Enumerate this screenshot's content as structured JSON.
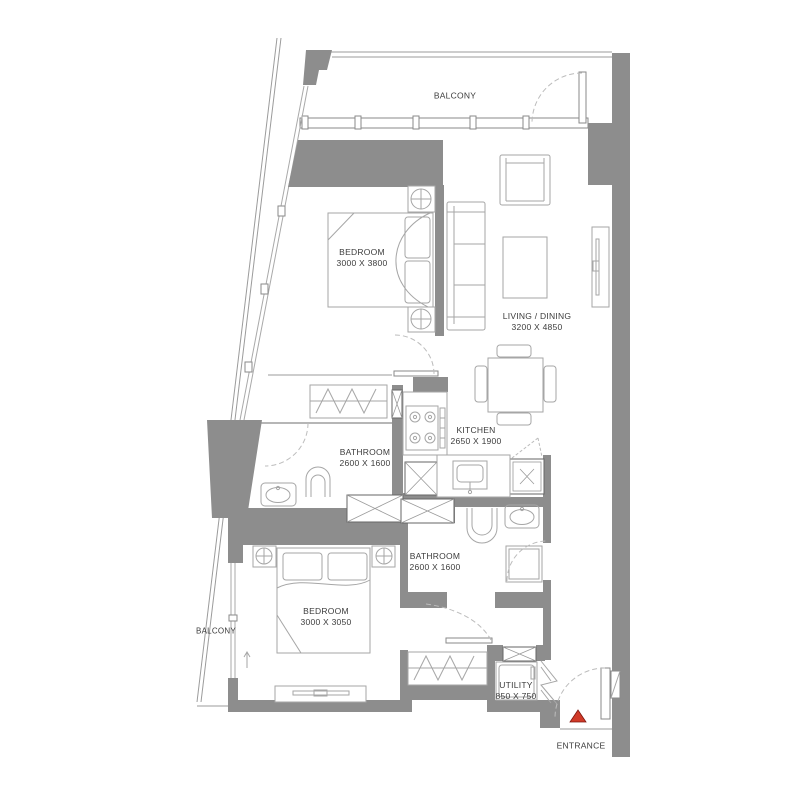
{
  "title": "Apartment Floor Plan",
  "colors": {
    "wall": "#8d8d8d",
    "outline": "#6d6d6d",
    "furniture_line": "#a6a6a6",
    "door_arc": "#bcbcbc",
    "label_text": "#3c3c3c",
    "entrance_marker": "#d03a28"
  },
  "rooms": [
    {
      "id": "balcony-top",
      "name": "BALCONY",
      "dims": ""
    },
    {
      "id": "bedroom-1",
      "name": "BEDROOM",
      "dims": "3000 X 3800"
    },
    {
      "id": "living-dining",
      "name": "LIVING / DINING",
      "dims": "3200 X 4850"
    },
    {
      "id": "kitchen",
      "name": "KITCHEN",
      "dims": "2650 X 1900"
    },
    {
      "id": "bathroom-1",
      "name": "BATHROOM",
      "dims": "2600 X 1600"
    },
    {
      "id": "bathroom-2",
      "name": "BATHROOM",
      "dims": "2600 X 1600"
    },
    {
      "id": "bedroom-2",
      "name": "BEDROOM",
      "dims": "3000 X 3050"
    },
    {
      "id": "balcony-left",
      "name": "BALCONY",
      "dims": ""
    },
    {
      "id": "utility",
      "name": "UTILITY",
      "dims": "850 X 750"
    },
    {
      "id": "entrance",
      "name": "ENTRANCE",
      "dims": ""
    }
  ],
  "fixtures": [
    "bed",
    "pillows",
    "nightstand-lamps",
    "sofa",
    "armchair",
    "coffee-table",
    "tv-unit",
    "dining-table",
    "chairs",
    "hob",
    "kitchen-sink",
    "toilet",
    "washbasin",
    "shower",
    "washing-machine",
    "wardrobe",
    "service-shafts"
  ]
}
